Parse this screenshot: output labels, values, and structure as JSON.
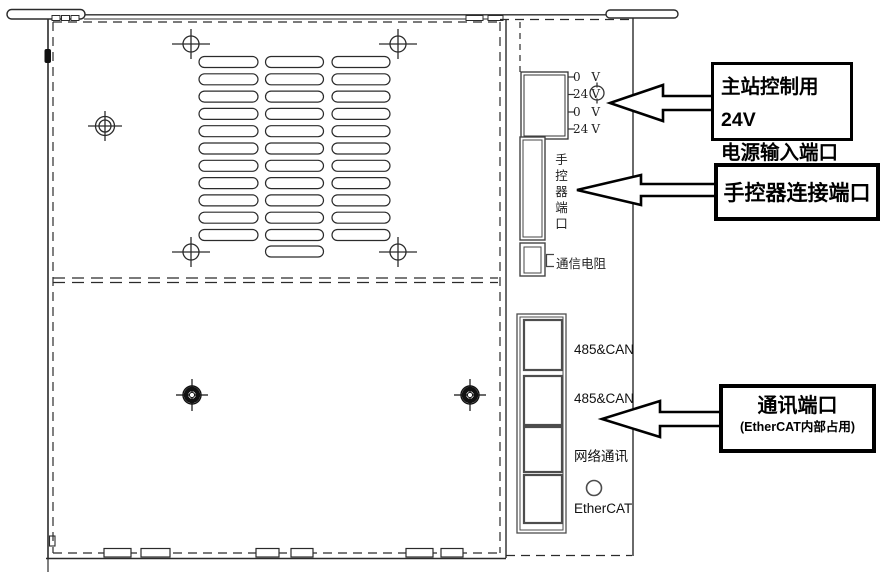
{
  "diagram": {
    "power_terminal": {
      "pins": [
        {
          "value": "0",
          "unit": "V"
        },
        {
          "value": "24",
          "unit": "V"
        },
        {
          "value": "0",
          "unit": "V"
        },
        {
          "value": "24",
          "unit": "V"
        }
      ]
    },
    "hand_controller_port": {
      "label": "手控器端口"
    },
    "comm_resistor": {
      "label": "通信电阻"
    },
    "comm_ports": {
      "labels": [
        "485&CAN",
        "485&CAN",
        "网络通讯",
        "EtherCAT"
      ]
    },
    "callouts": {
      "power": {
        "line1": "主站控制用24V",
        "line2": "电源输入端口"
      },
      "hand_controller": {
        "label": "手控器连接端口"
      },
      "comm": {
        "title": "通讯端口",
        "subtitle": "(EtherCAT内部占用)"
      }
    },
    "colors": {
      "line": "#2b2b2b",
      "callout": "#000000",
      "port_line": "#4d4d4d"
    }
  }
}
